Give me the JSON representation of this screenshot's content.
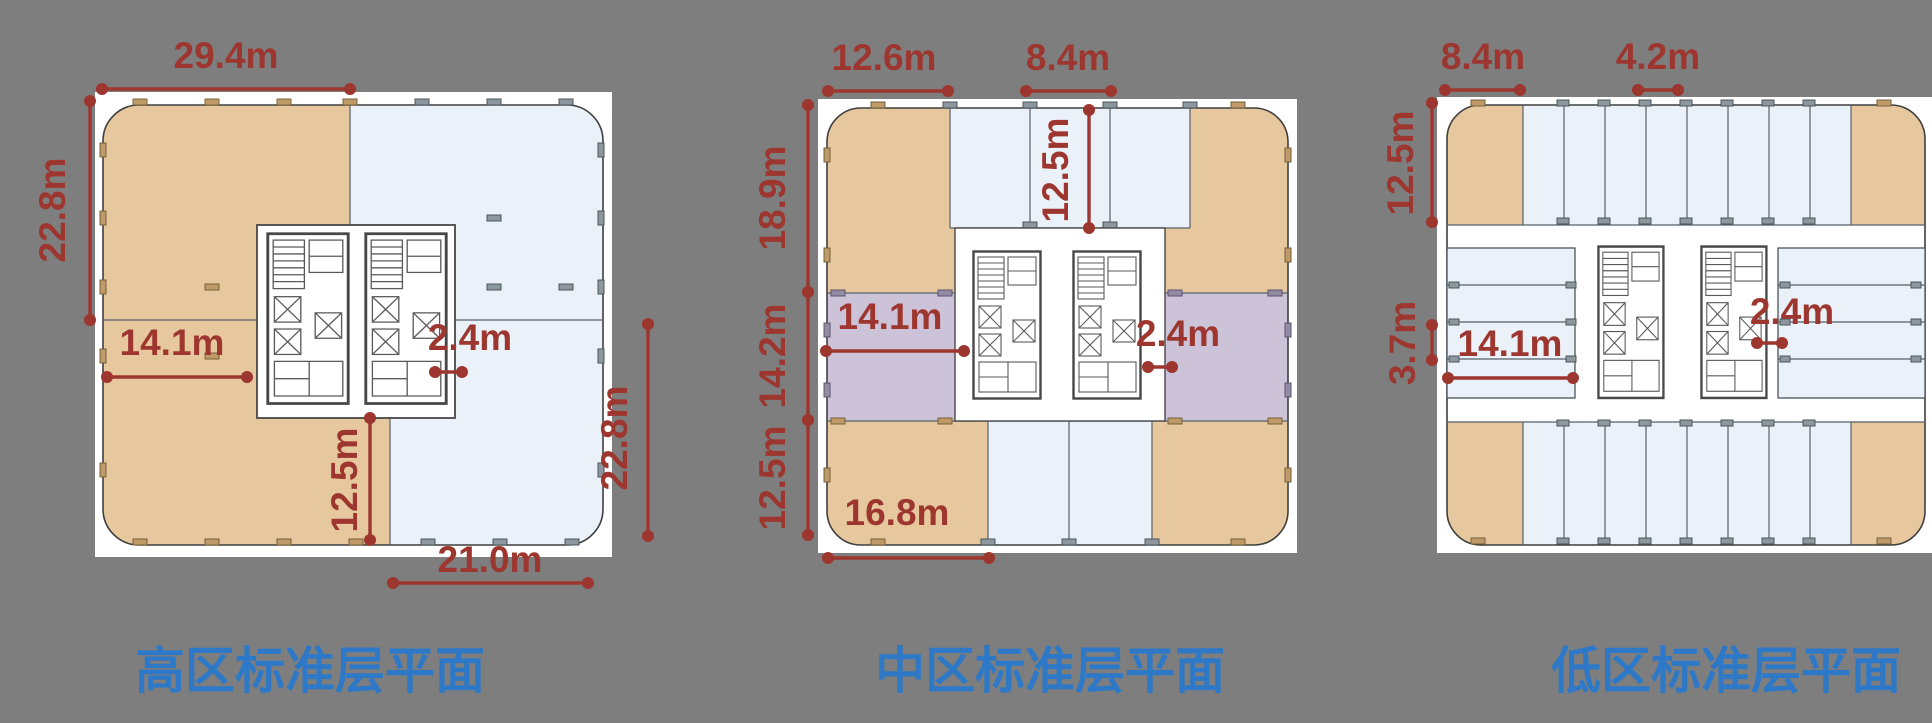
{
  "canvas": {
    "background": "#7e7e7e",
    "width": 1932,
    "height": 723
  },
  "colors": {
    "dimension_red": "#9d362f",
    "title_blue": "#2e79c7",
    "office_tan": "#e7c89e",
    "office_blue": "#eaf1f8",
    "hotel_purple": "#ccc3d8",
    "plan_white": "#ffffff"
  },
  "plans": [
    {
      "id": "high-zone",
      "title": "高区标准层平面",
      "dims": {
        "top_width": "29.4m",
        "left_height": "22.8m",
        "inner_width": "14.1m",
        "core_corridor": "2.4m",
        "inner_depth": "12.5m",
        "bottom_width": "21.0m",
        "right_height": "22.8m"
      }
    },
    {
      "id": "mid-zone",
      "title": "中区标准层平面",
      "dims": {
        "top_left_width": "12.6m",
        "top_center_width": "8.4m",
        "inner_top_depth": "12.5m",
        "left_upper_height": "18.9m",
        "left_middle_height": "14.2m",
        "left_lower_height": "12.5m",
        "middle_width": "14.1m",
        "core_corridor": "2.4m",
        "bottom_left_width": "16.8m"
      }
    },
    {
      "id": "low-zone",
      "title": "低区标准层平面",
      "dims": {
        "top_left_width": "8.4m",
        "top_bay_width": "4.2m",
        "left_upper_height": "12.5m",
        "left_bay_height": "3.7m",
        "middle_width": "14.1m",
        "core_corridor": "2.4m"
      }
    }
  ]
}
